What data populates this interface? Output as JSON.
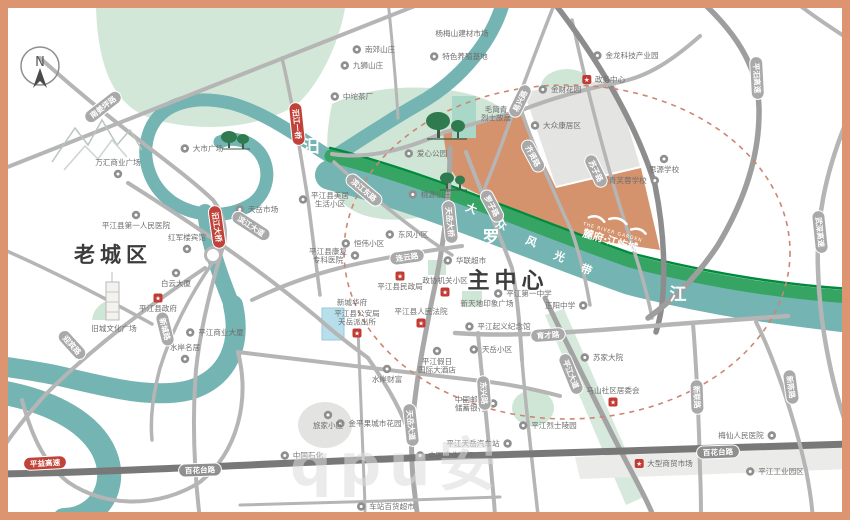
{
  "map": {
    "compass": "N",
    "watermark": "qpu安",
    "palette": {
      "frame": "#dd9470",
      "river": "#74b4b2",
      "park": "#d3e7d8",
      "band": "#36a463",
      "band_edge": "#008a3e",
      "project": "#d4936c",
      "road": "#b5b5b5",
      "road_dark": "#787878",
      "pill_red": "#c04238",
      "dashed_ring": "#cc8672"
    },
    "project": {
      "name": "麓府·江屿城",
      "sub": "THE RIVER GARDEN"
    },
    "districts": [
      {
        "label": "老城区",
        "x": 113,
        "y": 262,
        "size": 21
      },
      {
        "label": "主中心",
        "x": 508,
        "y": 288,
        "size": 22
      }
    ],
    "river_chars": [
      {
        "t": "汨",
        "x": 311,
        "y": 152
      },
      {
        "t": "罗",
        "x": 491,
        "y": 243
      },
      {
        "t": "江",
        "x": 678,
        "y": 300
      }
    ],
    "band_chars": [
      {
        "t": "大",
        "x": 470,
        "y": 212
      },
      {
        "t": "众",
        "x": 500,
        "y": 228
      },
      {
        "t": "风",
        "x": 530,
        "y": 245
      },
      {
        "t": "光",
        "x": 558,
        "y": 260
      },
      {
        "t": "带",
        "x": 585,
        "y": 273
      }
    ],
    "pills": [
      {
        "t": "南姜坪路",
        "x": 103,
        "y": 107,
        "r": -38
      },
      {
        "t": "汨江一桥",
        "x": 297,
        "y": 124,
        "r": 84,
        "s": "red"
      },
      {
        "t": "汨江大桥",
        "x": 217,
        "y": 227,
        "r": 82,
        "s": "red"
      },
      {
        "t": "滨江大道",
        "x": 251,
        "y": 226,
        "r": 33
      },
      {
        "t": "滨江东路",
        "x": 364,
        "y": 190,
        "r": 40
      },
      {
        "t": "迎宾路",
        "x": 72,
        "y": 345,
        "r": 48
      },
      {
        "t": "新城路",
        "x": 165,
        "y": 329,
        "r": 76
      },
      {
        "t": "连云路",
        "x": 407,
        "y": 257,
        "r": -8
      },
      {
        "t": "罗子路",
        "x": 492,
        "y": 206,
        "r": 62
      },
      {
        "t": "天岳大桥",
        "x": 450,
        "y": 222,
        "r": 84
      },
      {
        "t": "齐贤路",
        "x": 533,
        "y": 156,
        "r": 62
      },
      {
        "t": "易兴路",
        "x": 520,
        "y": 101,
        "r": -64
      },
      {
        "t": "苏子路",
        "x": 596,
        "y": 171,
        "r": 64
      },
      {
        "t": "平汨高速",
        "x": 757,
        "y": 78,
        "r": 87
      },
      {
        "t": "武深高速",
        "x": 820,
        "y": 232,
        "r": 84
      },
      {
        "t": "育才路",
        "x": 548,
        "y": 335,
        "r": -4
      },
      {
        "t": "平江大道",
        "x": 571,
        "y": 374,
        "r": 68
      },
      {
        "t": "天岳大道",
        "x": 411,
        "y": 425,
        "r": 84
      },
      {
        "t": "东兴路",
        "x": 484,
        "y": 393,
        "r": 86
      },
      {
        "t": "新联路",
        "x": 697,
        "y": 397,
        "r": 88
      },
      {
        "t": "新陈路",
        "x": 791,
        "y": 387,
        "r": 82
      },
      {
        "t": "百花台路",
        "x": 200,
        "y": 470,
        "r": -2,
        "s": "dark"
      },
      {
        "t": "百花台路",
        "x": 718,
        "y": 452,
        "r": -2,
        "s": "dark"
      },
      {
        "t": "平益高速",
        "x": 45,
        "y": 463,
        "r": -3,
        "s": "red"
      }
    ],
    "pois": [
      {
        "label": "杨梅山建材市场",
        "x": 462,
        "y": 36,
        "icon": "none"
      },
      {
        "label": "特色养殖基地",
        "x": 465,
        "y": 59,
        "icon": "dot"
      },
      {
        "label": "南郊山庄",
        "x": 380,
        "y": 52,
        "icon": "dot"
      },
      {
        "label": "九狮山庄",
        "x": 368,
        "y": 68,
        "icon": "dot"
      },
      {
        "label": "中坨茶厂",
        "x": 358,
        "y": 99,
        "icon": "dot"
      },
      {
        "label": "金龙科技产业园",
        "x": 632,
        "y": 58,
        "icon": "dot"
      },
      {
        "label": "政务中心",
        "x": 610,
        "y": 82,
        "icon": "red"
      },
      {
        "label": "金财花园",
        "x": 566,
        "y": 92,
        "icon": "dot"
      },
      {
        "label": "大众康居区",
        "x": 562,
        "y": 128,
        "icon": "dot"
      },
      {
        "lines": [
          "毛简青",
          "烈士故居"
        ],
        "x": 496,
        "y": 112,
        "icon": "none"
      },
      {
        "label": "爱心公园",
        "x": 432,
        "y": 156,
        "icon": "dot"
      },
      {
        "label": "桃源山庄",
        "x": 436,
        "y": 197,
        "icon": "dot"
      },
      {
        "label": "大市广场",
        "x": 208,
        "y": 151,
        "icon": "dot"
      },
      {
        "label": "万汇商业广场",
        "x": 118,
        "y": 165,
        "icon": "dot",
        "ipos": "b"
      },
      {
        "label": "颐青芙蓉学校",
        "x": 624,
        "y": 183,
        "icon": "dot",
        "ipos": "r"
      },
      {
        "label": "思源学校",
        "x": 664,
        "y": 172,
        "icon": "dot",
        "ipos": "a"
      },
      {
        "label": "天岳市场",
        "x": 263,
        "y": 212,
        "icon": "dot"
      },
      {
        "label": "平江县第一人民医院",
        "x": 136,
        "y": 228,
        "icon": "dot",
        "ipos": "a"
      },
      {
        "label": "红军楼宾馆",
        "x": 187,
        "y": 240,
        "icon": "dot",
        "ipos": "b"
      },
      {
        "label": "白云大厦",
        "x": 176,
        "y": 286,
        "icon": "dot",
        "ipos": "a"
      },
      {
        "label": "平江县政府",
        "x": 158,
        "y": 311,
        "icon": "star",
        "ipos": "a"
      },
      {
        "label": "旧城文化广场",
        "x": 114,
        "y": 331,
        "icon": "none"
      },
      {
        "label": "平江商业大厦",
        "x": 221,
        "y": 335,
        "icon": "dot"
      },
      {
        "label": "水岸名居",
        "x": 185,
        "y": 350,
        "icon": "dot",
        "ipos": "b"
      },
      {
        "lines": [
          "平江县美居",
          "生活小区"
        ],
        "x": 330,
        "y": 198,
        "icon": "dot"
      },
      {
        "lines": [
          "平江县康复",
          "专科医院"
        ],
        "x": 328,
        "y": 254,
        "icon": "dot",
        "ipos": "r"
      },
      {
        "label": "恒伟小区",
        "x": 369,
        "y": 246,
        "icon": "dot"
      },
      {
        "label": "东风小区",
        "x": 413,
        "y": 237,
        "icon": "dot"
      },
      {
        "label": "平江县民政局",
        "x": 400,
        "y": 289,
        "icon": "red",
        "ipos": "a"
      },
      {
        "label": "政协机关小区",
        "x": 445,
        "y": 283,
        "icon": "red",
        "ipos": "b"
      },
      {
        "label": "新城华府",
        "x": 352,
        "y": 305,
        "icon": "none"
      },
      {
        "lines": [
          "平江县公安局",
          "天岳派出所"
        ],
        "x": 357,
        "y": 316,
        "icon": "red",
        "ipos": "b"
      },
      {
        "label": "华联超市",
        "x": 471,
        "y": 263,
        "icon": "dot"
      },
      {
        "label": "平江第一中学",
        "x": 529,
        "y": 296,
        "icon": "dot"
      },
      {
        "label": "新天地印象广场",
        "x": 487,
        "y": 306,
        "icon": "none"
      },
      {
        "label": "正阳中学",
        "x": 560,
        "y": 308,
        "icon": "dot",
        "ipos": "r"
      },
      {
        "label": "平江起义纪念馆",
        "x": 504,
        "y": 329,
        "icon": "dot"
      },
      {
        "label": "天岳小区",
        "x": 497,
        "y": 352,
        "icon": "dot"
      },
      {
        "label": "平江县人民法院",
        "x": 421,
        "y": 314,
        "icon": "red",
        "ipos": "b"
      },
      {
        "label": "苏家大院",
        "x": 608,
        "y": 360,
        "icon": "dot"
      },
      {
        "label": "马山社区居委会",
        "x": 613,
        "y": 393,
        "icon": "star",
        "ipos": "b"
      },
      {
        "label": "梅仙人民医院",
        "x": 741,
        "y": 438,
        "icon": "dot",
        "ipos": "r"
      },
      {
        "label": "平江工业园区",
        "x": 781,
        "y": 474,
        "icon": "dot"
      },
      {
        "label": "大型商贸市场",
        "x": 670,
        "y": 466,
        "icon": "red"
      },
      {
        "lines": [
          "平江假日",
          "国际大酒店"
        ],
        "x": 437,
        "y": 364,
        "icon": "dot",
        "ipos": "a"
      },
      {
        "label": "水岸财富",
        "x": 387,
        "y": 382,
        "icon": "dot",
        "ipos": "a"
      },
      {
        "lines": [
          "中国邮政",
          "储蓄银行"
        ],
        "x": 470,
        "y": 402,
        "icon": "dot",
        "ipos": "r"
      },
      {
        "label": "金平果城市花园",
        "x": 375,
        "y": 426,
        "icon": "dot"
      },
      {
        "label": "旅家小区",
        "x": 328,
        "y": 428,
        "icon": "dot",
        "ipos": "a"
      },
      {
        "label": "中国石化",
        "x": 308,
        "y": 458,
        "icon": "dot"
      },
      {
        "label": "中国农业银行",
        "x": 451,
        "y": 458,
        "icon": "dot"
      },
      {
        "label": "平江天岳汽车站",
        "x": 473,
        "y": 446,
        "icon": "dot",
        "ipos": "r"
      },
      {
        "label": "平江烈士陵园",
        "x": 554,
        "y": 428,
        "icon": "dot"
      },
      {
        "label": "车站百货超市",
        "x": 392,
        "y": 509,
        "icon": "dot"
      }
    ]
  }
}
